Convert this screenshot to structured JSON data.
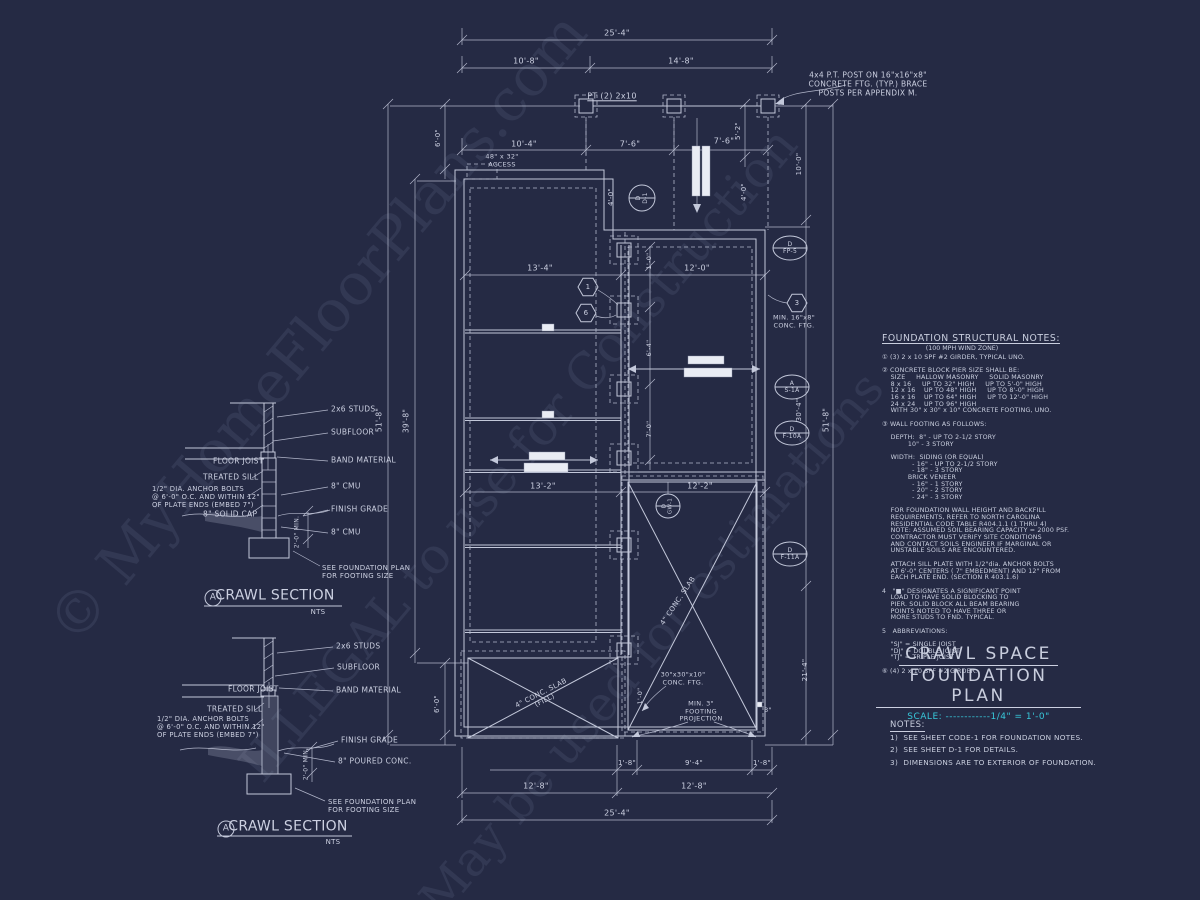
{
  "colors": {
    "background": "#252a44",
    "linework": "#c3c8da",
    "accent_cyan": "#38c8da",
    "white_box": "#e9ecf4"
  },
  "watermark": {
    "line1": "© MyHomeFloorPlans.com",
    "line2": "ILLEGAL to use for Construction",
    "line3": "May be used for estimations"
  },
  "structural_notes": {
    "title": "FOUNDATION STRUCTURAL NOTES:",
    "subtitle": "(100 MPH WIND ZONE)",
    "body": "① (3) 2 x 10 SPF #2 GIRDER, TYPICAL UNO.\n\n② CONCRETE BLOCK PIER SIZE SHALL BE:\n    SIZE     HALLOW MASONRY     SOLID MASONRY\n    8 x 16     UP TO 32\" HIGH     UP TO 5'-0\" HIGH\n    12 x 16    UP TO 48\" HIGH     UP TO 8'-0\" HIGH\n    16 x 16    UP TO 64\" HIGH     UP TO 12'-0\" HIGH\n    24 x 24    UP TO 96\" HIGH\n    WITH 30\" x 30\" x 10\" CONCRETE FOOTING, UNO.\n\n③ WALL FOOTING AS FOLLOWS:\n\n    DEPTH:  8\" - UP TO 2-1/2 STORY\n            10\" - 3 STORY\n\n    WIDTH:  SIDING (OR EQUAL)\n              - 16\" - UP TO 2-1/2 STORY\n              - 18\" - 3 STORY\n            BRICK VENEER\n              - 16\" - 1 STORY\n              - 20\" - 2 STORY\n              - 24\" - 3 STORY\n\n    FOR FOUNDATION WALL HEIGHT AND BACKFILL\n    REQUIREMENTS, REFER TO NORTH CAROLINA\n    RESIDENTIAL CODE TABLE R404.1.1 (1 THRU 4)\n    NOTE: ASSUMED SOIL BEARING CAPACITY = 2000 PSF.\n    CONTRACTOR MUST VERIFY SITE CONDITIONS\n    AND CONTACT SOILS ENGINEER IF MARGINAL OR\n    UNSTABLE SOILS ARE ENCOUNTERED.\n\n    ATTACH SILL PLATE WITH 1/2\"dia. ANCHOR BOLTS\n    AT 6'-0\" CENTERS ( 7\" EMBEDMENT) AND 12\" FROM\n    EACH PLATE END. (SECTION R 403.1.6)\n\n4   \"■\" DESIGNATES A SIGNIFICANT POINT\n    LOAD TO HAVE SOLID BLOCKING TO\n    PIER. SOLID BLOCK ALL BEAM BEARING\n    POINTS NOTED TO HAVE THREE OR\n    MORE STUDS TO FND. TYPICAL.\n\n5   ABBREVIATIONS:\n\n    \"SJ\" = SINGLE JOIST\n    \"DJ\" = DOUBLE JOIST\n    \"TJ\" = TRIPLE JOIST\n\n⑥ (4) 2 x 10 SPF #2 GIRDER."
  },
  "title_block": {
    "line1": "CRAWL SPACE",
    "line2": "FOUNDATION PLAN",
    "scale_label": "SCALE:",
    "scale_dots": " ------------",
    "scale_value": "1/4\" = 1'-0\""
  },
  "notes": {
    "heading": "NOTES:",
    "items": [
      "1)  SEE SHEET CODE-1 FOR FOUNDATION NOTES.",
      "2)  SEE SHEET D-1 FOR DETAILS.",
      "3)  DIMENSIONS ARE TO EXTERIOR OF FOUNDATION."
    ]
  },
  "annotations": [
    {
      "n": "dim-overall-top",
      "t": "25'-4\"",
      "x": 617,
      "y": 33,
      "f": 8
    },
    {
      "n": "dim-10-8",
      "t": "10'-8\"",
      "x": 526,
      "y": 61,
      "f": 8
    },
    {
      "n": "dim-14-8",
      "t": "14'-8\"",
      "x": 681,
      "y": 61,
      "f": 8
    },
    {
      "n": "post-note",
      "t": "4x4 P.T. POST ON 16\"x16\"x8\"\nCONCRETE FTG. (TYP.) BRACE\nPOSTS PER APPENDIX M.",
      "x": 868,
      "y": 85,
      "f": 7.5
    },
    {
      "n": "girder-label",
      "t": "PT (2) 2x10",
      "x": 612,
      "y": 96,
      "f": 8,
      "u": 1
    },
    {
      "n": "dim-10-4",
      "t": "10'-4\"",
      "x": 524,
      "y": 144,
      "f": 8
    },
    {
      "n": "dim-7-6-a",
      "t": "7'-6\"",
      "x": 630,
      "y": 144,
      "f": 8
    },
    {
      "n": "dim-7-6-b",
      "t": "7'-6\"",
      "x": 724,
      "y": 141,
      "f": 8
    },
    {
      "n": "dim-5-2",
      "t": "5'-2\"",
      "x": 738,
      "y": 131,
      "r": -90,
      "f": 7
    },
    {
      "n": "dim-6-0-top",
      "t": "6'-0\"",
      "x": 438,
      "y": 138,
      "r": -90,
      "f": 7
    },
    {
      "n": "access-label",
      "t": "48\" x 32\"\nACCESS",
      "x": 502,
      "y": 161,
      "f": 6.5
    },
    {
      "n": "dim-4-0-a",
      "t": "4'-0\"",
      "x": 611,
      "y": 197,
      "r": -90,
      "f": 7
    },
    {
      "n": "dim-4-0-b",
      "t": "4'-0\"",
      "x": 744,
      "y": 192,
      "r": -90,
      "f": 7
    },
    {
      "n": "callout-d1",
      "t": "D\nD-1",
      "x": 642,
      "y": 198,
      "r": -90,
      "f": 6
    },
    {
      "n": "dim-51-8-left",
      "t": "51'-8\"",
      "x": 380,
      "y": 420,
      "r": -90,
      "f": 7.5
    },
    {
      "n": "dim-39-8",
      "t": "39'-8\"",
      "x": 407,
      "y": 421,
      "r": -90,
      "f": 7.5
    },
    {
      "n": "dim-6-0-bottom",
      "t": "6'-0\"",
      "x": 437,
      "y": 704,
      "r": -90,
      "f": 7
    },
    {
      "n": "dim-10-0",
      "t": "10'-0\"",
      "x": 799,
      "y": 164,
      "r": -90,
      "f": 7
    },
    {
      "n": "dim-30-4",
      "t": "30'-4\"",
      "x": 799,
      "y": 410,
      "r": -90,
      "f": 7
    },
    {
      "n": "dim-21-4",
      "t": "21'-4\"",
      "x": 805,
      "y": 670,
      "r": -90,
      "f": 7
    },
    {
      "n": "dim-51-8-right",
      "t": "51'-8\"",
      "x": 827,
      "y": 420,
      "r": -90,
      "f": 7.5
    },
    {
      "n": "callout-fp5",
      "t": "D\nFP-5",
      "x": 790,
      "y": 248,
      "f": 6
    },
    {
      "n": "hex-3-label",
      "t": "3",
      "x": 797,
      "y": 303,
      "f": 7
    },
    {
      "n": "min-ftg-note",
      "t": "MIN. 16\"x8\"\nCONC. FTG.",
      "x": 794,
      "y": 322,
      "f": 6.5
    },
    {
      "n": "callout-s1a",
      "t": "A\nS-1A",
      "x": 792,
      "y": 387,
      "f": 6
    },
    {
      "n": "callout-f10a",
      "t": "D\nF-10A",
      "x": 792,
      "y": 433,
      "f": 6
    },
    {
      "n": "callout-f11a",
      "t": "D\nF-11A",
      "x": 790,
      "y": 554,
      "f": 6
    },
    {
      "n": "dim-13-4",
      "t": "13'-4\"",
      "x": 540,
      "y": 268,
      "f": 8
    },
    {
      "n": "dim-12-0",
      "t": "12'-0\"",
      "x": 697,
      "y": 268,
      "f": 8
    },
    {
      "n": "dim-1-0",
      "t": "1'-0\"",
      "x": 650,
      "y": 261,
      "r": -90,
      "f": 6.5
    },
    {
      "n": "dim-6-4",
      "t": "6'-4\"",
      "x": 650,
      "y": 348,
      "r": -90,
      "f": 6.5
    },
    {
      "n": "dim-7-0",
      "t": "7'-0\"",
      "x": 650,
      "y": 429,
      "r": -90,
      "f": 6.5
    },
    {
      "n": "hex-1-label",
      "t": "1",
      "x": 588,
      "y": 287,
      "f": 7
    },
    {
      "n": "hex-6-label",
      "t": "6",
      "x": 586,
      "y": 313,
      "f": 7
    },
    {
      "n": "dim-13-2",
      "t": "13'-2\"",
      "x": 543,
      "y": 486,
      "f": 8
    },
    {
      "n": "dim-12-2",
      "t": "12'-2\"",
      "x": 700,
      "y": 486,
      "f": 8
    },
    {
      "n": "callout-gw1",
      "t": "D\nGW-1",
      "x": 668,
      "y": 506,
      "r": -90,
      "f": 5.5
    },
    {
      "n": "slab-note-right",
      "t": "4\" CONC. SLAB",
      "x": 678,
      "y": 601,
      "r": -56,
      "f": 7
    },
    {
      "n": "slab-note-left",
      "t": "4\" CONC. SLAB\n(FILL)",
      "x": 543,
      "y": 697,
      "r": -27,
      "f": 7
    },
    {
      "n": "pier-ftg-note",
      "t": "30\"x30\"x10\"\nCONC. FTG.",
      "x": 683,
      "y": 679,
      "f": 6.5
    },
    {
      "n": "min-3-note",
      "t": "MIN. 3\"\nFOOTING\nPROJECTION",
      "x": 701,
      "y": 712,
      "f": 6.5
    },
    {
      "n": "dim-1-0-b",
      "t": "1'-0\"",
      "x": 641,
      "y": 696,
      "r": -90,
      "f": 6.5
    },
    {
      "n": "dim-3in",
      "t": "3\"",
      "x": 768,
      "y": 711,
      "f": 6.5
    },
    {
      "n": "dim-1-8-a",
      "t": "1'-8\"",
      "x": 627,
      "y": 763,
      "f": 7
    },
    {
      "n": "dim-9-4",
      "t": "9'-4\"",
      "x": 694,
      "y": 763,
      "f": 7
    },
    {
      "n": "dim-1-8-b",
      "t": "1'-8\"",
      "x": 762,
      "y": 763,
      "f": 7
    },
    {
      "n": "dim-12-8-a",
      "t": "12'-8\"",
      "x": 536,
      "y": 786,
      "f": 8
    },
    {
      "n": "dim-12-8-b",
      "t": "12'-8\"",
      "x": 694,
      "y": 786,
      "f": 8
    },
    {
      "n": "dim-overall-bottom",
      "t": "25'-4\"",
      "x": 617,
      "y": 813,
      "f": 8
    },
    {
      "n": "us-studs-label",
      "t": "2x6 STUDS",
      "x": 331,
      "y": 410,
      "a": "l",
      "f": 7.5
    },
    {
      "n": "us-subfloor-label",
      "t": "SUBFLOOR",
      "x": 331,
      "y": 433,
      "a": "l",
      "f": 7.5
    },
    {
      "n": "us-band-label",
      "t": "BAND MATERIAL",
      "x": 331,
      "y": 461,
      "a": "l",
      "f": 7.5
    },
    {
      "n": "us-cmu-upper-label",
      "t": "8\" CMU",
      "x": 331,
      "y": 487,
      "a": "l",
      "f": 7.5
    },
    {
      "n": "us-grade-label",
      "t": "FINISH GRADE",
      "x": 331,
      "y": 510,
      "a": "l",
      "f": 7.5
    },
    {
      "n": "us-cmu-lower-label",
      "t": "8\" CMU",
      "x": 331,
      "y": 533,
      "a": "l",
      "f": 7.5
    },
    {
      "n": "us-see-fnd-label",
      "t": "SEE FOUNDATION PLAN\nFOR FOOTING SIZE",
      "x": 322,
      "y": 572,
      "a": "l",
      "f": 7
    },
    {
      "n": "us-floor-joist-label",
      "t": "FLOOR JOIST",
      "x": 213,
      "y": 462,
      "a": "l",
      "f": 7.5
    },
    {
      "n": "us-treated-sill-label",
      "t": "TREATED SILL",
      "x": 203,
      "y": 478,
      "a": "l",
      "f": 7.5
    },
    {
      "n": "us-anchor-note",
      "t": "1/2\" DIA. ANCHOR BOLTS\n@ 6'-0\" O.C. AND WITHIN 12\"\nOF PLATE ENDS (EMBED 7\")",
      "x": 152,
      "y": 497,
      "a": "l",
      "f": 6.8
    },
    {
      "n": "us-solid-cap-label",
      "t": "8\" SOLID CAP",
      "x": 203,
      "y": 515,
      "a": "l",
      "f": 7.5
    },
    {
      "n": "us-dim-2-min",
      "t": "2'-0\" MIN.",
      "x": 297,
      "y": 532,
      "r": -90,
      "f": 6
    },
    {
      "n": "us-section-title",
      "t": "CRAWL SECTION",
      "x": 275,
      "y": 596,
      "f": 14
    },
    {
      "n": "us-section-bubble",
      "t": "A",
      "x": 213,
      "y": 598,
      "f": 9
    },
    {
      "n": "us-nts",
      "t": "NTS",
      "x": 318,
      "y": 612,
      "f": 7
    },
    {
      "n": "ls-studs-label",
      "t": "2x6 STUDS",
      "x": 336,
      "y": 647,
      "a": "l",
      "f": 7.5
    },
    {
      "n": "ls-subfloor-label",
      "t": "SUBFLOOR",
      "x": 337,
      "y": 668,
      "a": "l",
      "f": 7.5
    },
    {
      "n": "ls-band-label",
      "t": "BAND MATERIAL",
      "x": 336,
      "y": 691,
      "a": "l",
      "f": 7.5
    },
    {
      "n": "ls-grade-label",
      "t": "FINISH GRADE",
      "x": 341,
      "y": 741,
      "a": "l",
      "f": 7.5
    },
    {
      "n": "ls-poured-label",
      "t": "8\" POURED CONC.",
      "x": 338,
      "y": 762,
      "a": "l",
      "f": 7.5
    },
    {
      "n": "ls-see-fnd-label",
      "t": "SEE FOUNDATION PLAN\nFOR FOOTING SIZE",
      "x": 328,
      "y": 806,
      "a": "l",
      "f": 7
    },
    {
      "n": "ls-floor-joist-label",
      "t": "FLOOR JOIST",
      "x": 228,
      "y": 690,
      "a": "l",
      "f": 7.5
    },
    {
      "n": "ls-treated-sill-label",
      "t": "TREATED SILL",
      "x": 207,
      "y": 710,
      "a": "l",
      "f": 7.5
    },
    {
      "n": "ls-anchor-note",
      "t": "1/2\" DIA. ANCHOR BOLTS\n@ 6'-0\" O.C. AND WITHIN 12\"\nOF PLATE ENDS (EMBED 7\")",
      "x": 157,
      "y": 727,
      "a": "l",
      "f": 6.8
    },
    {
      "n": "ls-dim-2-min",
      "t": "2'-0\" MIN.",
      "x": 306,
      "y": 764,
      "r": -90,
      "f": 6
    },
    {
      "n": "ls-section-title",
      "t": "CRAWL SECTION",
      "x": 288,
      "y": 827,
      "f": 14
    },
    {
      "n": "ls-section-bubble",
      "t": "A",
      "x": 226,
      "y": 829,
      "f": 9
    },
    {
      "n": "ls-nts",
      "t": "NTS",
      "x": 333,
      "y": 842,
      "f": 7
    }
  ]
}
